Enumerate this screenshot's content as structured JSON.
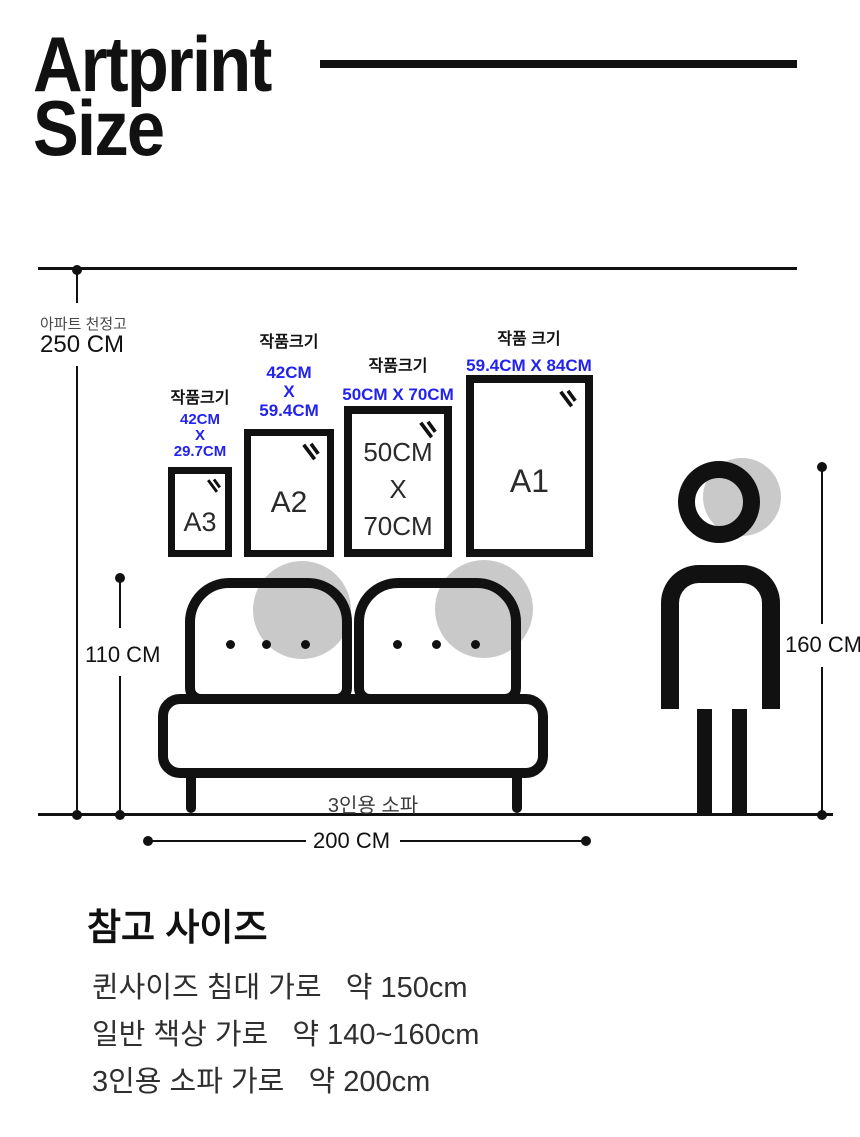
{
  "colors": {
    "background": "#ffffff",
    "ink": "#111111",
    "accent_blue": "#2323ee",
    "gray_fill": "#c9c9c9",
    "muted_text": "#4a4a4a",
    "body_text": "#2f2f2f"
  },
  "header": {
    "title_line1": "Artprint",
    "title_line2": "Size"
  },
  "ceiling": {
    "label": "아파트 천정고",
    "value": "250 CM"
  },
  "frames": [
    {
      "label": "작품크기",
      "dims_line1": "42CM",
      "dims_line2": "X",
      "dims_line3": "29.7CM",
      "name": "A3"
    },
    {
      "label": "작품크기",
      "dims_line1": "42CM",
      "dims_line2": "X",
      "dims_line3": "59.4CM",
      "name": "A2"
    },
    {
      "label": "작품크기",
      "dims_line1": "50CM X 70CM",
      "inner_line1": "50CM",
      "inner_line2": "X",
      "inner_line3": "70CM"
    },
    {
      "label": "작품 크기",
      "dims_line1": "59.4CM X 84CM",
      "name": "A1"
    }
  ],
  "dimensions": {
    "sofa_height": "110 CM",
    "sofa_width": "200 CM",
    "person_height": "160 CM"
  },
  "sofa": {
    "label": "3인용 소파"
  },
  "reference": {
    "heading": "참고 사이즈",
    "items": [
      "퀸사이즈 침대 가로   약 150cm",
      "일반 책상 가로   약 140~160cm",
      "3인용 소파 가로   약 200cm"
    ]
  }
}
